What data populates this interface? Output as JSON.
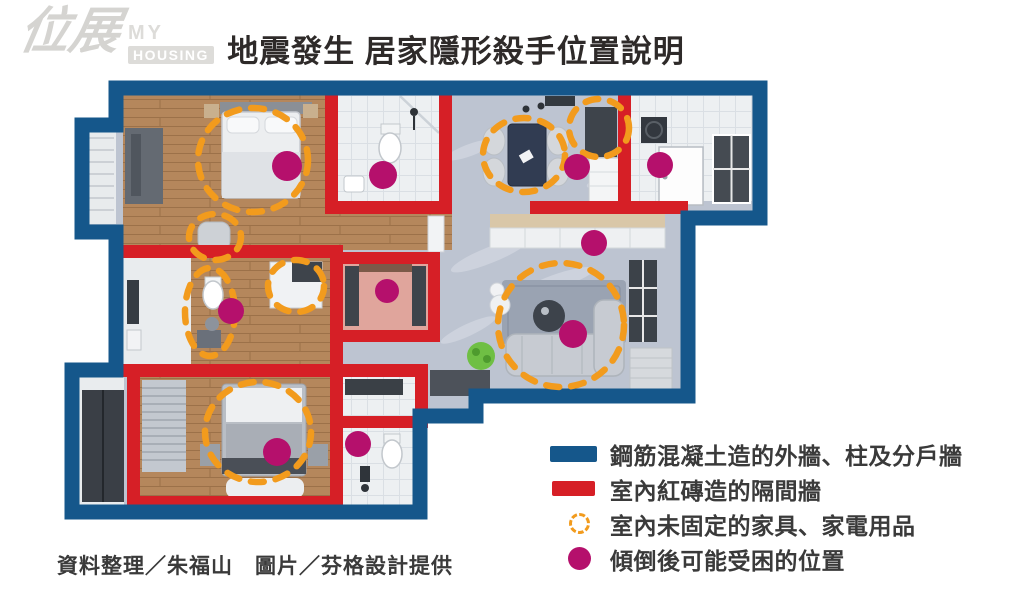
{
  "logo": {
    "brand_zh": "位展",
    "brand_en_top": "MY",
    "brand_en_bottom": "HOUSING"
  },
  "title": "地震發生 居家隱形殺手位置說明",
  "credits": "資料整理／朱福山　圖片／芬格設計提供",
  "legend": {
    "items": [
      {
        "id": "concrete-wall",
        "swatch": "bar-blue",
        "label": "鋼筋混凝土造的外牆、柱及分戶牆"
      },
      {
        "id": "brick-wall",
        "swatch": "bar-red",
        "label": "室內紅磚造的隔間牆"
      },
      {
        "id": "unfixed-furniture",
        "swatch": "dashed-circle",
        "label": "室內未固定的家具、家電用品"
      },
      {
        "id": "trap-position",
        "swatch": "dot",
        "label": "傾倒後可能受困的位置"
      }
    ]
  },
  "colors": {
    "wall_blue": "#15578b",
    "wall_red": "#d61f26",
    "hazard_dot": "#b5106c",
    "furniture_circle": "#f29b1d"
  },
  "floorplan": {
    "hazard_dots": [
      {
        "x": 287,
        "y": 166,
        "r": 15
      },
      {
        "x": 383,
        "y": 175,
        "r": 14
      },
      {
        "x": 577,
        "y": 167,
        "r": 13
      },
      {
        "x": 660,
        "y": 165,
        "r": 13
      },
      {
        "x": 594,
        "y": 243,
        "r": 13
      },
      {
        "x": 387,
        "y": 291,
        "r": 12
      },
      {
        "x": 231,
        "y": 311,
        "r": 13
      },
      {
        "x": 573,
        "y": 334,
        "r": 14
      },
      {
        "x": 277,
        "y": 452,
        "r": 14
      },
      {
        "x": 358,
        "y": 444,
        "r": 13
      }
    ],
    "furniture_circles": [
      {
        "x": 253,
        "y": 160,
        "rx": 55,
        "ry": 52
      },
      {
        "x": 215,
        "y": 237,
        "rx": 26,
        "ry": 23
      },
      {
        "x": 524,
        "y": 155,
        "rx": 41,
        "ry": 37
      },
      {
        "x": 599,
        "y": 128,
        "rx": 30,
        "ry": 29
      },
      {
        "x": 210,
        "y": 312,
        "rx": 25,
        "ry": 44
      },
      {
        "x": 296,
        "y": 286,
        "rx": 28,
        "ry": 26
      },
      {
        "x": 561,
        "y": 325,
        "rx": 63,
        "ry": 62
      },
      {
        "x": 258,
        "y": 432,
        "rx": 53,
        "ry": 50
      }
    ]
  }
}
